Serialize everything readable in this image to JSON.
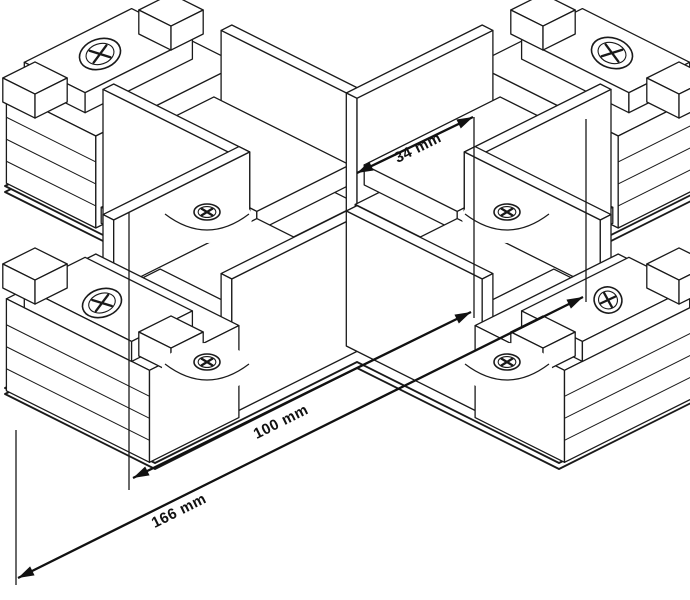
{
  "figure": {
    "type": "isometric-technical-drawing",
    "subject": "X-shaped track connector"
  },
  "canvas": {
    "width": 690,
    "height": 600,
    "background": "#ffffff",
    "line_color": "#1a1a1a"
  },
  "dimensions": [
    {
      "label": "34 mm",
      "value": 34,
      "unit": "mm",
      "from": [
        357,
        173
      ],
      "to": [
        473,
        117
      ],
      "label_pos": [
        420,
        152
      ],
      "angle": -26.5
    },
    {
      "label": "100 mm",
      "value": 100,
      "unit": "mm",
      "from": [
        133,
        478
      ],
      "to": [
        471,
        312
      ],
      "label_pos": [
        283,
        426
      ],
      "angle": -26.5
    },
    {
      "label": "166 mm",
      "value": 166,
      "unit": "mm",
      "from": [
        18,
        578
      ],
      "to": [
        583,
        297
      ],
      "label_pos": [
        181,
        515
      ],
      "angle": -26.5
    }
  ],
  "extension_lines": [
    [
      129,
      212,
      129,
      490
    ],
    [
      474,
      117,
      474,
      318
    ],
    [
      16,
      430,
      16,
      585
    ],
    [
      586,
      119,
      586,
      302
    ]
  ],
  "drawing": {
    "origin": [
      357,
      287
    ],
    "iso": {
      "ax": 0.8944,
      "ay": 0.4472
    },
    "cover_outer": [
      [
        559,
        111
      ],
      [
        709,
        186
      ],
      [
        507,
        287
      ],
      [
        709,
        388
      ],
      [
        559,
        463
      ],
      [
        357,
        362
      ],
      [
        155,
        463
      ],
      [
        5,
        388
      ],
      [
        207,
        287
      ],
      [
        5,
        186
      ],
      [
        155,
        111
      ],
      [
        357,
        212
      ]
    ],
    "cover_inner": [
      [
        531,
        155
      ],
      [
        621,
        200
      ],
      [
        446,
        287
      ],
      [
        621,
        374
      ],
      [
        531,
        419
      ],
      [
        357,
        332
      ],
      [
        183,
        419
      ],
      [
        93,
        374
      ],
      [
        268,
        287
      ],
      [
        93,
        200
      ],
      [
        183,
        155
      ],
      [
        357,
        242
      ]
    ],
    "cover_shadow_dy": 6,
    "boxes": [
      {
        "n": "nw-cap-block",
        "a": [
          -80,
          80
        ],
        "b": [
          -312,
          -212
        ],
        "h": [
          0,
          92
        ],
        "el": {
          "f": "-a",
          "hs": [
            22,
            44,
            66
          ]
        }
      },
      {
        "n": "nw-cap-step",
        "a": [
          -60,
          60
        ],
        "b": [
          -312,
          -244
        ],
        "h": [
          92,
          112
        ]
      },
      {
        "n": "nw-cap-hook-left",
        "a": [
          -94,
          -58
        ],
        "b": [
          -302,
          -266
        ],
        "h": [
          92,
          116
        ]
      },
      {
        "n": "nw-cap-hook-right",
        "a": [
          58,
          94
        ],
        "b": [
          -302,
          -266
        ],
        "h": [
          92,
          116
        ]
      },
      {
        "n": "nw-wall-right",
        "a": [
          60,
          72
        ],
        "b": [
          -212,
          -60
        ],
        "h": [
          0,
          135
        ]
      },
      {
        "n": "nw-rib-1",
        "a": [
          -74,
          74
        ],
        "b": [
          -212,
          -166
        ],
        "h": [
          2,
          18
        ]
      },
      {
        "n": "nw-rib-2",
        "a": [
          -66,
          66
        ],
        "b": [
          -212,
          -166
        ],
        "h": [
          28,
          44
        ]
      },
      {
        "n": "nw-rib-3",
        "a": [
          -54,
          54
        ],
        "b": [
          -212,
          -166
        ],
        "h": [
          54,
          68
        ]
      },
      {
        "n": "nw-shelf-low",
        "a": [
          -62,
          62
        ],
        "b": [
          -212,
          -60
        ],
        "h": [
          8,
          28
        ]
      },
      {
        "n": "nw-shelf-up",
        "a": [
          -52,
          52
        ],
        "b": [
          -212,
          -60
        ],
        "h": [
          52,
          72
        ]
      },
      {
        "n": "nw-wall-left",
        "a": [
          -72,
          -60
        ],
        "b": [
          -212,
          -60
        ],
        "h": [
          0,
          135
        ]
      },
      {
        "n": "ne-cap-block",
        "a": [
          212,
          312
        ],
        "b": [
          -80,
          80
        ],
        "h": [
          0,
          92
        ],
        "el": {
          "f": "+b",
          "hs": [
            22,
            44,
            66
          ]
        }
      },
      {
        "n": "ne-cap-step",
        "a": [
          244,
          312
        ],
        "b": [
          -60,
          60
        ],
        "h": [
          92,
          112
        ]
      },
      {
        "n": "ne-cap-hook-top",
        "a": [
          266,
          302
        ],
        "b": [
          -94,
          -58
        ],
        "h": [
          92,
          116
        ]
      },
      {
        "n": "ne-cap-hook-bottom",
        "a": [
          266,
          302
        ],
        "b": [
          58,
          94
        ],
        "h": [
          92,
          116
        ]
      },
      {
        "n": "ne-wall-top",
        "a": [
          60,
          212
        ],
        "b": [
          -72,
          -60
        ],
        "h": [
          0,
          135
        ]
      },
      {
        "n": "ne-rib-1",
        "a": [
          166,
          212
        ],
        "b": [
          -74,
          74
        ],
        "h": [
          2,
          18
        ]
      },
      {
        "n": "ne-rib-2",
        "a": [
          166,
          212
        ],
        "b": [
          -66,
          66
        ],
        "h": [
          28,
          44
        ]
      },
      {
        "n": "ne-rib-3",
        "a": [
          166,
          212
        ],
        "b": [
          -54,
          54
        ],
        "h": [
          54,
          68
        ]
      },
      {
        "n": "ne-shelf-low",
        "a": [
          60,
          212
        ],
        "b": [
          -62,
          62
        ],
        "h": [
          8,
          28
        ]
      },
      {
        "n": "ne-shelf-up",
        "a": [
          60,
          212
        ],
        "b": [
          -52,
          52
        ],
        "h": [
          52,
          72
        ]
      },
      {
        "n": "ne-wall-bottom",
        "a": [
          60,
          212
        ],
        "b": [
          60,
          72
        ],
        "h": [
          0,
          135
        ]
      },
      {
        "n": "sw-wall-top",
        "a": [
          -212,
          -60
        ],
        "b": [
          -72,
          -60
        ],
        "h": [
          0,
          135
        ]
      },
      {
        "n": "sw-shelf-low",
        "a": [
          -212,
          -60
        ],
        "b": [
          -62,
          62
        ],
        "h": [
          8,
          28
        ]
      },
      {
        "n": "sw-shelf-up",
        "a": [
          -212,
          -60
        ],
        "b": [
          -52,
          52
        ],
        "h": [
          52,
          72
        ]
      },
      {
        "n": "sw-rib-1",
        "a": [
          -212,
          -166
        ],
        "b": [
          -74,
          74
        ],
        "h": [
          2,
          18
        ]
      },
      {
        "n": "sw-rib-2",
        "a": [
          -212,
          -166
        ],
        "b": [
          -66,
          66
        ],
        "h": [
          28,
          44
        ]
      },
      {
        "n": "sw-rib-3",
        "a": [
          -212,
          -166
        ],
        "b": [
          -54,
          54
        ],
        "h": [
          54,
          68
        ]
      },
      {
        "n": "sw-wall-bottom",
        "a": [
          -212,
          -60
        ],
        "b": [
          60,
          72
        ],
        "h": [
          0,
          135
        ]
      },
      {
        "n": "sw-cap-block",
        "a": [
          -312,
          -212
        ],
        "b": [
          -80,
          80
        ],
        "h": [
          0,
          92
        ],
        "el": {
          "f": "-a",
          "hs": [
            22,
            44,
            66
          ]
        }
      },
      {
        "n": "sw-cap-step",
        "a": [
          -312,
          -244
        ],
        "b": [
          -60,
          60
        ],
        "h": [
          92,
          112
        ]
      },
      {
        "n": "sw-cap-hook-top",
        "a": [
          -302,
          -266
        ],
        "b": [
          -94,
          -58
        ],
        "h": [
          92,
          116
        ]
      },
      {
        "n": "sw-cap-hook-bottom",
        "a": [
          -302,
          -266
        ],
        "b": [
          58,
          94
        ],
        "h": [
          92,
          116
        ]
      },
      {
        "n": "se-wall-right",
        "a": [
          60,
          72
        ],
        "b": [
          60,
          212
        ],
        "h": [
          0,
          135
        ]
      },
      {
        "n": "se-shelf-low",
        "a": [
          -62,
          62
        ],
        "b": [
          60,
          212
        ],
        "h": [
          8,
          28
        ]
      },
      {
        "n": "se-shelf-up",
        "a": [
          -52,
          52
        ],
        "b": [
          60,
          212
        ],
        "h": [
          52,
          72
        ]
      },
      {
        "n": "se-rib-1",
        "a": [
          -74,
          74
        ],
        "b": [
          166,
          212
        ],
        "h": [
          2,
          18
        ]
      },
      {
        "n": "se-rib-2",
        "a": [
          -66,
          66
        ],
        "b": [
          166,
          212
        ],
        "h": [
          28,
          44
        ]
      },
      {
        "n": "se-rib-3",
        "a": [
          -54,
          54
        ],
        "b": [
          166,
          212
        ],
        "h": [
          54,
          68
        ]
      },
      {
        "n": "se-wall-left",
        "a": [
          -72,
          -60
        ],
        "b": [
          60,
          212
        ],
        "h": [
          0,
          135
        ]
      },
      {
        "n": "se-cap-block",
        "a": [
          -80,
          80
        ],
        "b": [
          212,
          312
        ],
        "h": [
          0,
          92
        ],
        "el": {
          "f": "+b",
          "hs": [
            22,
            44,
            66
          ]
        }
      },
      {
        "n": "se-cap-step",
        "a": [
          -60,
          60
        ],
        "b": [
          244,
          312
        ],
        "h": [
          92,
          112
        ]
      },
      {
        "n": "se-cap-hook-left",
        "a": [
          -94,
          -58
        ],
        "b": [
          266,
          302
        ],
        "h": [
          92,
          116
        ]
      },
      {
        "n": "se-cap-hook-right",
        "a": [
          58,
          94
        ],
        "b": [
          266,
          302
        ],
        "h": [
          92,
          116
        ]
      }
    ],
    "cover_screws": [
      {
        "name": "cover-screw-nw",
        "pos": [
          207,
          212
        ],
        "rx": 13,
        "ry": 8
      },
      {
        "name": "cover-screw-ne",
        "pos": [
          507,
          212
        ],
        "rx": 13,
        "ry": 8
      },
      {
        "name": "cover-screw-sw",
        "pos": [
          207,
          362
        ],
        "rx": 13,
        "ry": 8
      },
      {
        "name": "cover-screw-se",
        "pos": [
          507,
          362
        ],
        "rx": 13,
        "ry": 8
      }
    ],
    "cap_screws": [
      {
        "name": "cap-screw-nw",
        "pos": [
          100,
          54
        ],
        "rot": -18,
        "rx": 21,
        "ry": 15
      },
      {
        "name": "cap-screw-ne",
        "pos": [
          612,
          53
        ],
        "rot": 18,
        "rx": 21,
        "ry": 15
      },
      {
        "name": "cap-screw-sw",
        "pos": [
          102,
          303
        ],
        "rot": -18,
        "rx": 20,
        "ry": 14
      },
      {
        "name": "cap-screw-se",
        "pos": [
          608,
          300
        ],
        "rot": 18,
        "rx": 14,
        "ry": 13
      }
    ]
  }
}
